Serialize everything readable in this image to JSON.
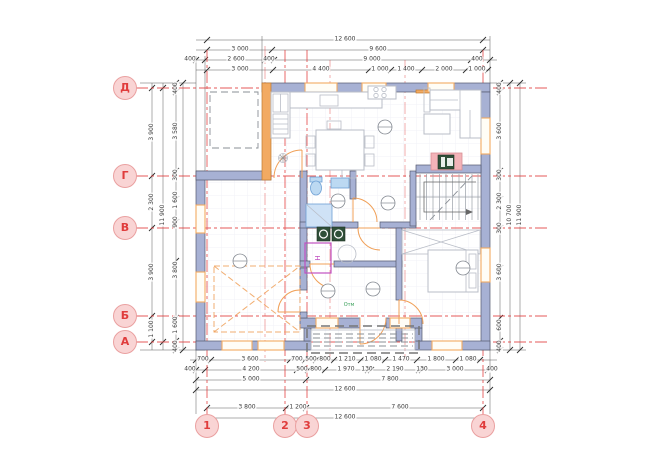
{
  "drawing": {
    "type": "architectural floor plan",
    "axis_labels": {
      "rows": [
        "Д",
        "Г",
        "В",
        "Б",
        "А"
      ],
      "cols": [
        "1",
        "2",
        "3",
        "4"
      ]
    },
    "dims": {
      "top": {
        "row1": [
          "12 600"
        ],
        "row2": [
          "3 000",
          "9 600"
        ],
        "row3": [
          "400",
          "2 600",
          "400",
          "9 000",
          "400"
        ],
        "row4": [
          "3 000",
          "4 400",
          "1 000",
          "1 400",
          "2 000",
          "1 000"
        ]
      },
      "bottom": {
        "row1": [
          "700",
          "3 600",
          "700",
          "500",
          "800",
          "1 210",
          "1 080",
          "1 470",
          "1 800",
          "1 080"
        ],
        "row2": [
          "400",
          "4 200",
          "500",
          "800",
          "1 970",
          "130",
          "2 190",
          "130",
          "3 000",
          "400"
        ],
        "row3": [
          "5 000",
          "7 800"
        ],
        "row4": [
          "12 600"
        ],
        "row5": [
          "3 800",
          "1 200",
          "7 600"
        ],
        "row6": [
          "12 600"
        ]
      },
      "left": {
        "col1": [
          "3 900",
          "2 300",
          "3 900",
          "1 100"
        ],
        "col2": [
          "11 900"
        ],
        "col3": [
          "400",
          "3 580",
          "300",
          "1 600",
          "900",
          "3 800",
          "1 600",
          "400"
        ]
      },
      "right": {
        "col1": [
          "400",
          "3 600",
          "300",
          "2 300",
          "300",
          "3 600",
          "600",
          "400"
        ],
        "col2": [
          "10 700"
        ],
        "col3": [
          "11 900"
        ]
      }
    },
    "plan_labels": {
      "heater": "Н",
      "elevation": "Отм"
    }
  },
  "colors": {
    "axis-red": "#e03c3c",
    "axis-circle-fill": "#f9d4d4",
    "axis-circle-stroke": "#eaa0a0",
    "wall-fill": "#a7b1d4",
    "wall-stroke": "#555a6e",
    "highlight-orange": "#f2aa62",
    "door-orange": "#f0a058",
    "fixture-blue": "#bcd9f2",
    "fixture-blue-stroke": "#6d9fd4",
    "pink-highlight": "#f3b3b8",
    "appliance-green": "#2f4f38",
    "magenta": "#c050c0",
    "dim-line": "#5a5a5a",
    "dim-text": "#3c3c3c",
    "furniture-stroke": "#b9bdc7",
    "dash-gray": "#8a8f96",
    "elevation-green": "#3aa05a"
  }
}
